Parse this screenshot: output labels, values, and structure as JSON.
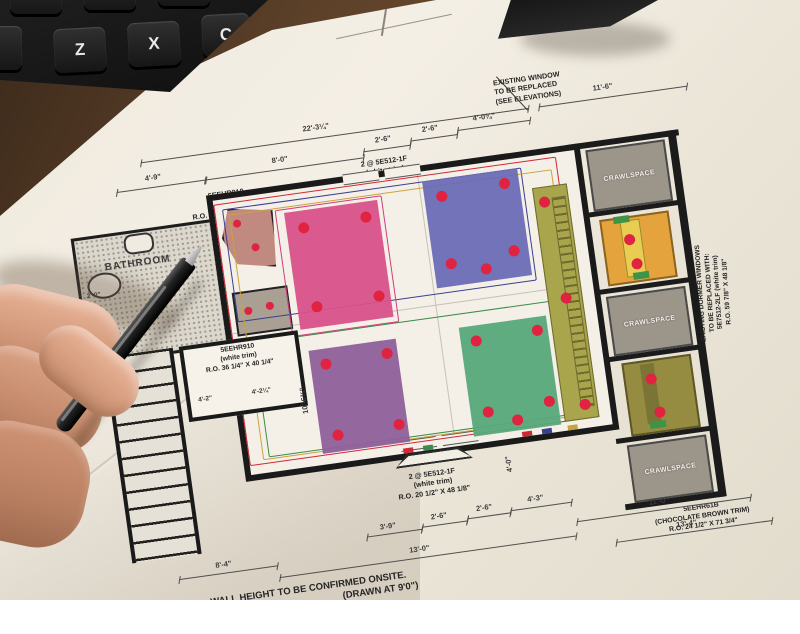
{
  "photo": {
    "keyboard": {
      "keys": [
        "Z",
        "X",
        "C"
      ]
    },
    "colors": {
      "paper": "#efe9dd",
      "desk": "#5d4129",
      "keyboard": "#161616"
    }
  },
  "plan": {
    "rooms": {
      "bathroom_label": "BATHROOM",
      "crawlspace_label": "CRAWLSPACE"
    },
    "windows": {
      "left_top": {
        "line1": "5EEHR910",
        "line2": "(white trim)",
        "line3": "R.O. 36 1/4\" X 40 1/4\""
      },
      "left_bottom": {
        "line1": "5EEHR910",
        "line2": "(white trim)",
        "line3": "R.O. 36 1/4\" X 40 1/4\""
      },
      "top_center": {
        "line1": "2 @ 5E512-1F",
        "line2": "(white trim)",
        "line3": "R.O. 20 1/2\" X 48 1/8\""
      },
      "bottom_center": {
        "line1": "2 @ 5E512-1F",
        "line2": "(white trim)",
        "line3": "R.O. 20 1/2\" X 48 1/8\""
      },
      "bottom_right": {
        "line1": "5EEHR61B",
        "line2": "(CHOCOLATE BROWN TRIM)",
        "line3": "R.O. 24 1/2\" X 71 3/4\""
      }
    },
    "notes": {
      "existing_window": {
        "line1": "EXISTING WINDOW",
        "line2": "TO BE REPLACED",
        "line3": "(SEE ELEVATIONS)"
      },
      "dormer": {
        "line1": "EXISTING DORMER WINDOWS",
        "line2": "TO BE REPLACED WITH:",
        "line3": "5E7512-2LF (white trim)",
        "line4": "R.O. 59 7/8\" X 48 1/8\""
      },
      "wall_height": {
        "line1": "WALL HEIGHT TO BE CONFIRMED ONSITE.",
        "line2": "(DRAWN AT 9'0\")"
      }
    },
    "dimensions": {
      "top_total": "22'-3¼\"",
      "top_right": "11'-6\"",
      "row2": [
        "4'-9\"",
        "8'-0\"",
        "2'-6\"",
        "2'-6\"",
        "4'-0¾\""
      ],
      "left_small": "2'-0\"",
      "vestibule": [
        "4'-2\"",
        "4'-2¼\""
      ],
      "vert_left": "10'-6¾\"",
      "vert_mid": "4'-0\"",
      "bottom_small": [
        "3'-9\"",
        "2'-6\"",
        "2'-6\"",
        "4'-3\""
      ],
      "bottom_13_0": "13'-0\"",
      "bottom_11_0": "11'-0\"",
      "bottom_13_4": "13'-4\"",
      "bottom_8_4": "8'-4\""
    },
    "colors": {
      "room_pink": "#d8518b",
      "room_indigo": "#6a6cb5",
      "room_purple": "#8f5f9b",
      "room_green": "#57a87b",
      "strip_olive": "#a8a54c",
      "dormer_orange": "#e5a33e",
      "dormer_olive": "#968c41",
      "crawl_grey": "#9c958a",
      "dot_red": "#df2340",
      "wire_red": "#cf2838",
      "wire_navy": "#3a3f8f",
      "wire_gold": "#c9a43c",
      "wire_green": "#3c8b4f",
      "wire_magenta": "#d23b80"
    }
  }
}
